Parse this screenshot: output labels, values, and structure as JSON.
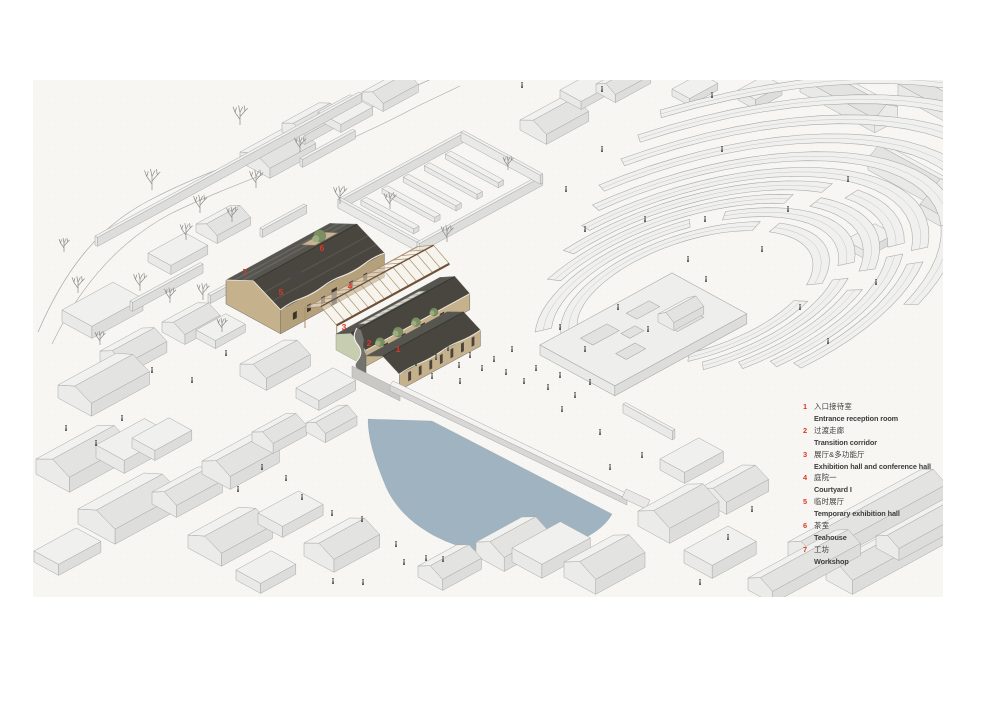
{
  "drawing": {
    "title": "axonometric site diagram",
    "type": "architectural-axonometric"
  },
  "colors": {
    "accent_red": "#dd3727",
    "paper": "#f7f6f3",
    "pond": "#9fb3c0",
    "ctx_top": "#f0f0ee",
    "ctx_side": "#e9e9e7",
    "ctx_side_dark": "#dddddb",
    "ctx_gable": "#ebebe9",
    "roof_light": "#f1f1ef",
    "roof_shade": "#e3e3e1",
    "line": "#a7a7a5",
    "roof": "#575550",
    "roof2": "#48463f",
    "wall": "#c5b28d",
    "wall2": "#b5a07c",
    "court": "#c7b493",
    "window": "#3a342b",
    "timber": "#6f5138",
    "timber_light": "#a98f6d",
    "glass": "#f5f1e6",
    "green_wall": "#c6cdb0",
    "green": "#7c8f63",
    "green2": "#9dad82",
    "plinth": "#c9c8c4",
    "figure": "#474744",
    "text_dark": "#3d3d3b"
  },
  "legend": {
    "items": [
      {
        "num": "1",
        "zh": "入口接待室",
        "en": "Entrance reception room"
      },
      {
        "num": "2",
        "zh": "过渡走廊",
        "en": "Transition corridor"
      },
      {
        "num": "3",
        "zh": "展厅&多功能厅",
        "en": "Exhibition hall and conference hall"
      },
      {
        "num": "4",
        "zh": "庭院一",
        "en": "Courtyard  I"
      },
      {
        "num": "5",
        "zh": "临时展厅",
        "en": "Temporary exhibition hall"
      },
      {
        "num": "6",
        "zh": "茶室",
        "en": "Teahouse"
      },
      {
        "num": "7",
        "zh": "工坊",
        "en": "Workshop"
      }
    ]
  },
  "markers": [
    {
      "num": "1"
    },
    {
      "num": "2"
    },
    {
      "num": "3"
    },
    {
      "num": "4"
    },
    {
      "num": "5"
    },
    {
      "num": "6"
    },
    {
      "num": "7"
    }
  ]
}
